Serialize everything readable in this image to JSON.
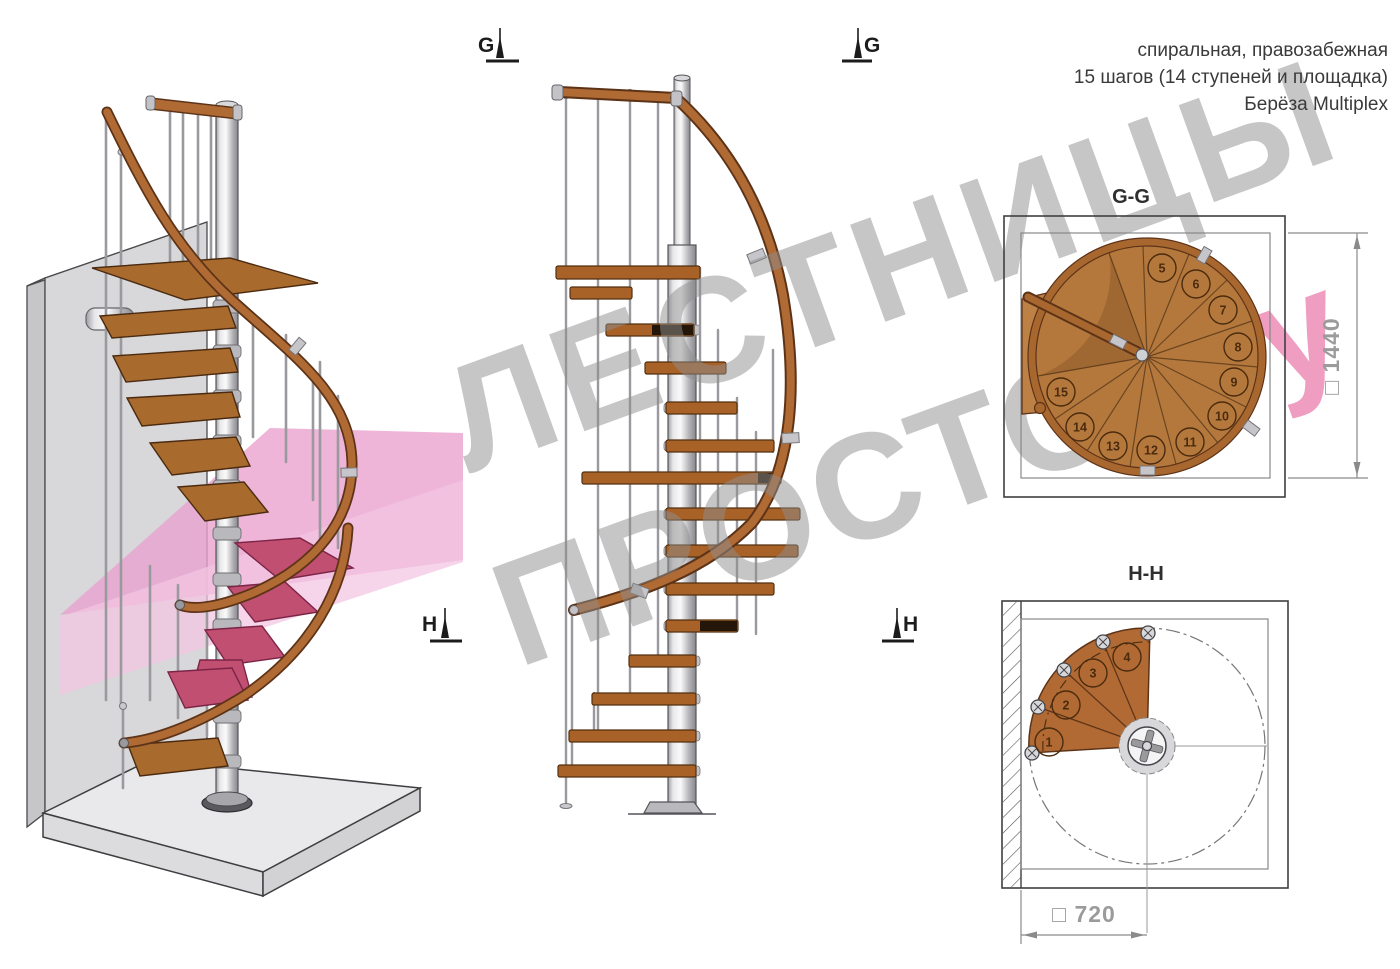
{
  "header": {
    "line1": "спиральная, правозабежная",
    "line2": "15 шагов (14 ступеней и площадка)",
    "line3": "Берёза Multiplex"
  },
  "section_markers": {
    "g_label": "G",
    "h_label": "H"
  },
  "plans": {
    "gg": {
      "title": "G-G",
      "dimension_label": "□ 1440",
      "steps": [
        "5",
        "6",
        "7",
        "8",
        "9",
        "10",
        "11",
        "12",
        "13",
        "14",
        "15"
      ]
    },
    "hh": {
      "title": "H-H",
      "dimension_label": "□ 720",
      "steps": [
        "1",
        "2",
        "3",
        "4"
      ]
    }
  },
  "watermark": {
    "line1": "ЛЕСТНИЦЫ",
    "line2_gray": "ПРОСТО",
    "line2_pink": ".Ру"
  },
  "colors": {
    "wood": "#b5783c",
    "wood_outline": "#5d3318",
    "rail_wood": "#b06a33",
    "metal": "#c9c9cd",
    "wall_gray": "#d8d8da",
    "floor_gray": "#e9e9eb",
    "section_plane_pink": "#eca4d2",
    "cut_step_magenta": "#c04f72",
    "watermark_gray": "#8f8f8f",
    "watermark_pink": "#e03f85",
    "dimension_gray": "#9b9b9b",
    "text_dark": "#3a3a3a"
  }
}
